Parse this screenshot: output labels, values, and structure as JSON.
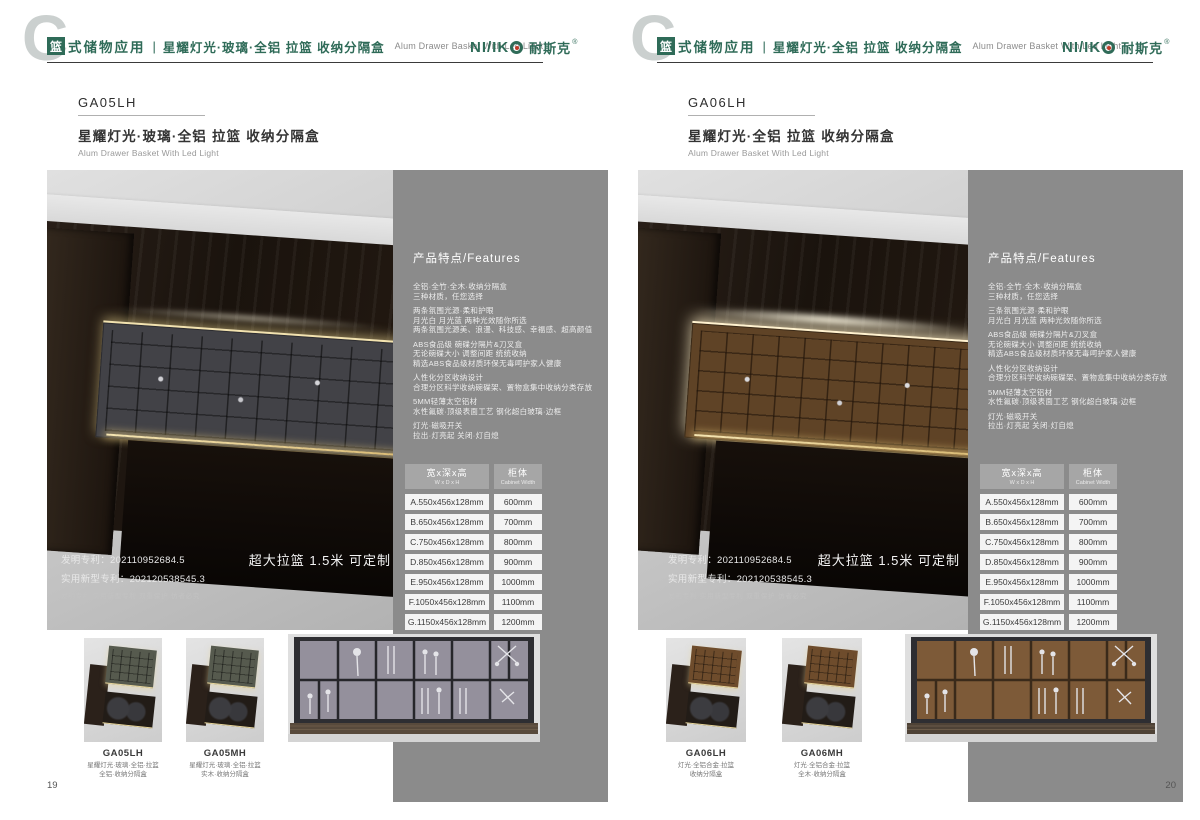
{
  "brand": {
    "c_mark": "C",
    "logo_prefix": "NI/IK",
    "logo_cn": "耐斯克",
    "reg_mark": "®"
  },
  "colors": {
    "brand_green": "#2f6b58",
    "logo_red": "#c23a28",
    "panel_gray": "#8b8b8b",
    "led_gold": "#f2e2af"
  },
  "pages": [
    {
      "page_number": "19",
      "header": {
        "badge": "篮",
        "category": "式储物应用",
        "divider": "|",
        "subtitle_cn": "星耀灯光·玻璃·全铝 拉篮 收纳分隔盒",
        "subtitle_en": "Alum Drawer Basket With Led Light"
      },
      "product": {
        "code": "GA05LH",
        "title_cn": "星耀灯光·玻璃·全铝 拉篮 收纳分隔盒",
        "title_en": "Alum Drawer Basket With Led Light"
      },
      "photo_overlay": {
        "patent_line1": "发明专利：202110952684.5",
        "patent_line2": "实用新型专利：202120538545.3",
        "patent_line3": "发明专利 实用新型专利 双重保护 仿者必究",
        "oversize_note": "超大拉篮 1.5米 可定制"
      },
      "features": {
        "heading": "产品特点/Features",
        "groups": [
          "全铝·全竹·全木·收纳分隔盒\n三种材质，任您选择",
          "两条氛围光源·柔和护眼\n月光白 月光蓝 两种光效随你所选\n两条氛围光源美、浪漫、科技感、幸福感、超高颜值",
          "ABS食品级 碗碟分隔片&刀叉盒\n无论碗碟大小 调整间距 统统收纳\n精选ABS食品级材质环保无毒呵护家人健康",
          "人性化分区收纳设计\n合理分区科学收纳碗碟架、置物盒集中收纳分类存放",
          "5MM轻薄太空铝材\n水性氟碳·顶级表面工艺 钢化超白玻璃·边框",
          "灯光·磁吸开关\n拉出·灯亮起 关闭·灯自熄"
        ]
      },
      "size_table": {
        "col1_cn": "宽x深x高",
        "col1_en": "W x D x H",
        "col2_cn": "柜体",
        "col2_en": "Cabinet Width",
        "rows": [
          {
            "size": "A.550x456x128mm",
            "width": "600mm"
          },
          {
            "size": "B.650x456x128mm",
            "width": "700mm"
          },
          {
            "size": "C.750x456x128mm",
            "width": "800mm"
          },
          {
            "size": "D.850x456x128mm",
            "width": "900mm"
          },
          {
            "size": "E.950x456x128mm",
            "width": "1000mm"
          },
          {
            "size": "F.1050x456x128mm",
            "width": "1100mm"
          },
          {
            "size": "G.1150x456x128mm",
            "width": "1200mm"
          }
        ]
      },
      "thumbnails": [
        {
          "code": "GA05LH",
          "caption": "星耀灯光·玻璃·全铝·拉篮\n全铝·收纳分隔盒"
        },
        {
          "code": "GA05MH",
          "caption": "星耀灯光·玻璃·全铝·拉篮\n实木·收纳分隔盒"
        }
      ]
    },
    {
      "page_number": "20",
      "header": {
        "badge": "篮",
        "category": "式储物应用",
        "divider": "|",
        "subtitle_cn": "星耀灯光·全铝 拉篮 收纳分隔盒",
        "subtitle_en": "Alum Drawer Basket With Led Light"
      },
      "product": {
        "code": "GA06LH",
        "title_cn": "星耀灯光·全铝 拉篮 收纳分隔盒",
        "title_en": "Alum Drawer Basket With Led Light"
      },
      "photo_overlay": {
        "patent_line1": "发明专利：202110952684.5",
        "patent_line2": "实用新型专利：202120538545.3",
        "patent_line3": "发明专利 实用新型专利 双重保护 仿者必究",
        "oversize_note": "超大拉篮 1.5米 可定制"
      },
      "features": {
        "heading": "产品特点/Features",
        "groups": [
          "全铝·全竹·全木·收纳分隔盒\n三种材质，任您选择",
          "三条氛围光源·柔和护眼\n月光白 月光蓝 两种光效随你所选",
          "ABS食品级 碗碟分隔片&刀叉盒\n无论碗碟大小 调整间距 统统收纳\n精选ABS食品级材质环保无毒呵护家人健康",
          "人性化分区收纳设计\n合理分区科学收纳碗碟架、置物盒集中收纳分类存放",
          "5MM轻薄太空铝材\n水性氟碳·顶级表面工艺 钢化超白玻璃·边框",
          "灯光·磁吸开关\n拉出·灯亮起 关闭·灯自熄"
        ]
      },
      "size_table": {
        "col1_cn": "宽x深x高",
        "col1_en": "W x D x H",
        "col2_cn": "柜体",
        "col2_en": "Cabinet Width",
        "rows": [
          {
            "size": "A.550x456x128mm",
            "width": "600mm"
          },
          {
            "size": "B.650x456x128mm",
            "width": "700mm"
          },
          {
            "size": "C.750x456x128mm",
            "width": "800mm"
          },
          {
            "size": "D.850x456x128mm",
            "width": "900mm"
          },
          {
            "size": "E.950x456x128mm",
            "width": "1000mm"
          },
          {
            "size": "F.1050x456x128mm",
            "width": "1100mm"
          },
          {
            "size": "G.1150x456x128mm",
            "width": "1200mm"
          }
        ]
      },
      "thumbnails": [
        {
          "code": "GA06LH",
          "caption": "灯光·全铝合金·拉篮\n收纳分隔盒"
        },
        {
          "code": "GA06MH",
          "caption": "灯光·全铝合金·拉篮\n全木·收纳分隔盒"
        }
      ]
    }
  ]
}
